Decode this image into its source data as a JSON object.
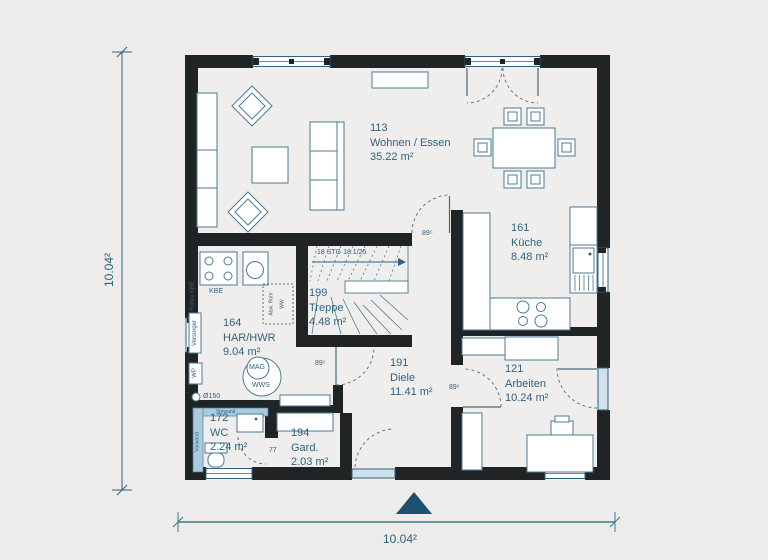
{
  "title": "Erdgeschoss Grundriss",
  "dimensions": {
    "left": "10.04²",
    "bottom": "10.04²"
  },
  "rooms": {
    "wohnen": {
      "number": "113",
      "name": "Wohnen / Essen",
      "area": "35.22 m²"
    },
    "kueche": {
      "number": "161",
      "name": "Küche",
      "area": "8.48 m²"
    },
    "treppe": {
      "number": "199",
      "name": "Treppe",
      "area": "4.48 m²"
    },
    "har": {
      "number": "164",
      "name": "HAR/HWR",
      "area": "9.04 m²"
    },
    "diele": {
      "number": "191",
      "name": "Diele",
      "area": "11.41 m²"
    },
    "arbeiten": {
      "number": "121",
      "name": "Arbeiten",
      "area": "10.24 m²"
    },
    "wc": {
      "number": "172",
      "name": "WC",
      "area": "2.24 m²"
    },
    "gard": {
      "number": "194",
      "name": "Gard.",
      "area": "2.03 m²"
    }
  },
  "stairs": {
    "note": "18 STG 18.1/25"
  },
  "doors": {
    "kitchen_width": "89⁵",
    "lobby_width": "89⁵",
    "arbeiten_width": "89⁵",
    "wc_width": "77"
  },
  "tech": {
    "kbe": "KBE",
    "rohre_kbe": "Rohre KBE",
    "versorger": "Versorger",
    "wp": "WP",
    "pipe": "Ø150",
    "mag": "MAG",
    "wws": "WWS",
    "riser_a": "Abw. Rohr",
    "riser_b": "WW",
    "vorwand": "Vorwand"
  },
  "colors": {
    "wall": "#212425",
    "text": "#31617e",
    "furniture_line": "#4a7b93",
    "window_fill": "#cfe2ec",
    "tile_strip": "#aacbdd",
    "entry_arrow": "#1d4f70",
    "background": "#edecea"
  }
}
